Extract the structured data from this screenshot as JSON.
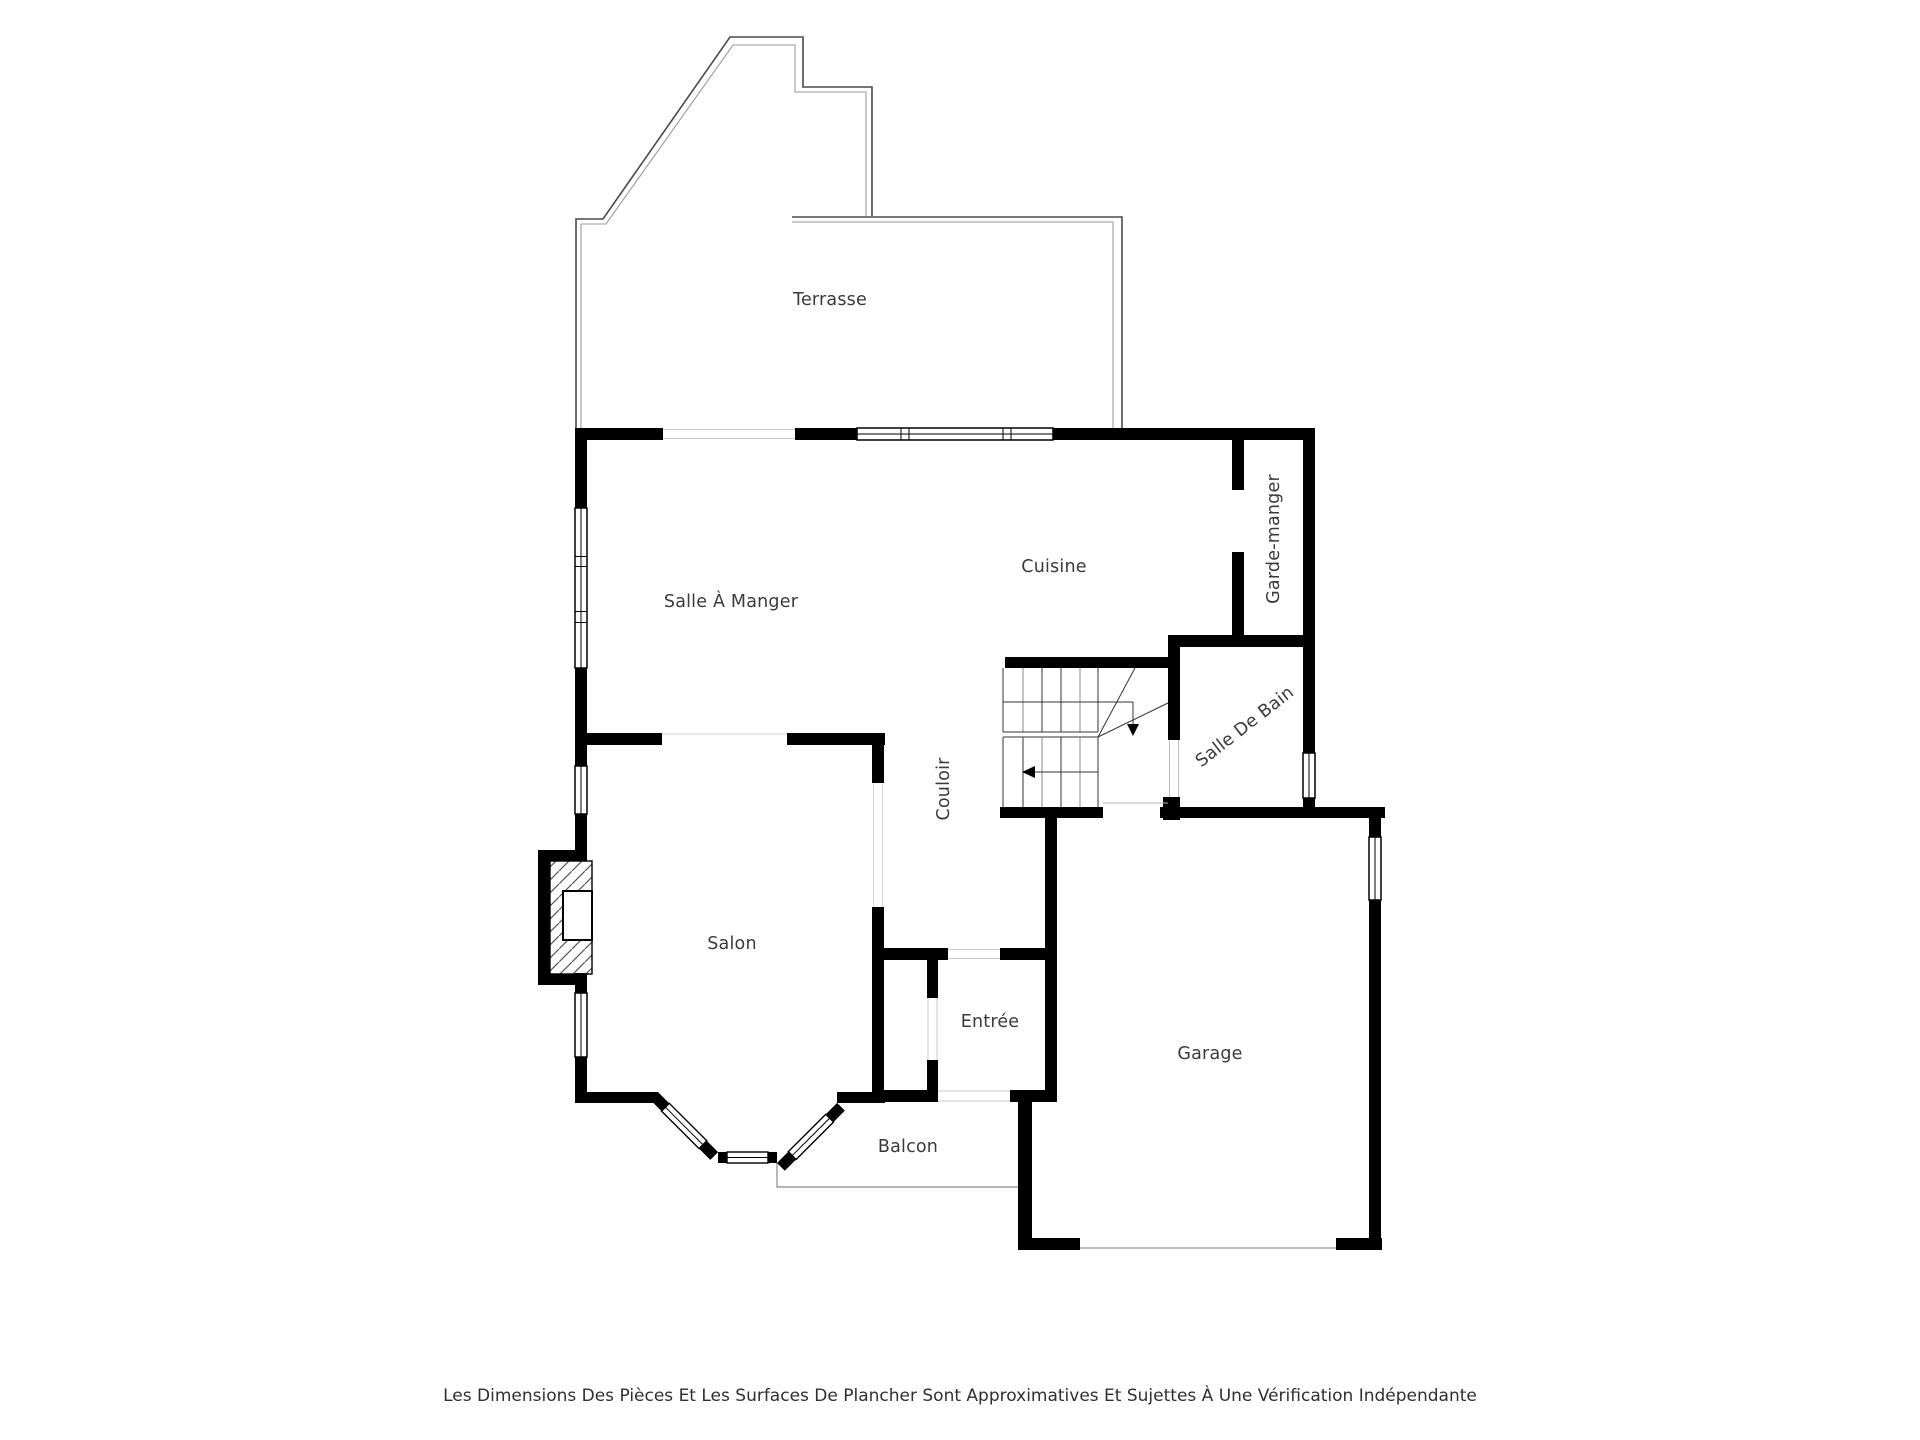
{
  "plan": {
    "labels": {
      "terrasse": "Terrasse",
      "salle_a_manger": "Salle À Manger",
      "cuisine": "Cuisine",
      "garde_manger": "Garde-manger",
      "salle_de_bain": "Salle De Bain",
      "couloir": "Couloir",
      "salon": "Salon",
      "entree": "Entrée",
      "garage": "Garage",
      "balcon": "Balcon"
    },
    "colors": {
      "wall": "#000000",
      "label_text": "#3a3a3a",
      "terrace_outline": "#4a4a4a",
      "terrace_inner": "#9a9a9a",
      "balcony_outline": "#888888",
      "stair_line": "#333333",
      "opening_line": "#c9c9c9"
    }
  },
  "footer": {
    "disclaimer": "Les Dimensions Des Pièces Et Les Surfaces De Plancher Sont Approximatives Et Sujettes À Une Vérification Indépendante"
  }
}
